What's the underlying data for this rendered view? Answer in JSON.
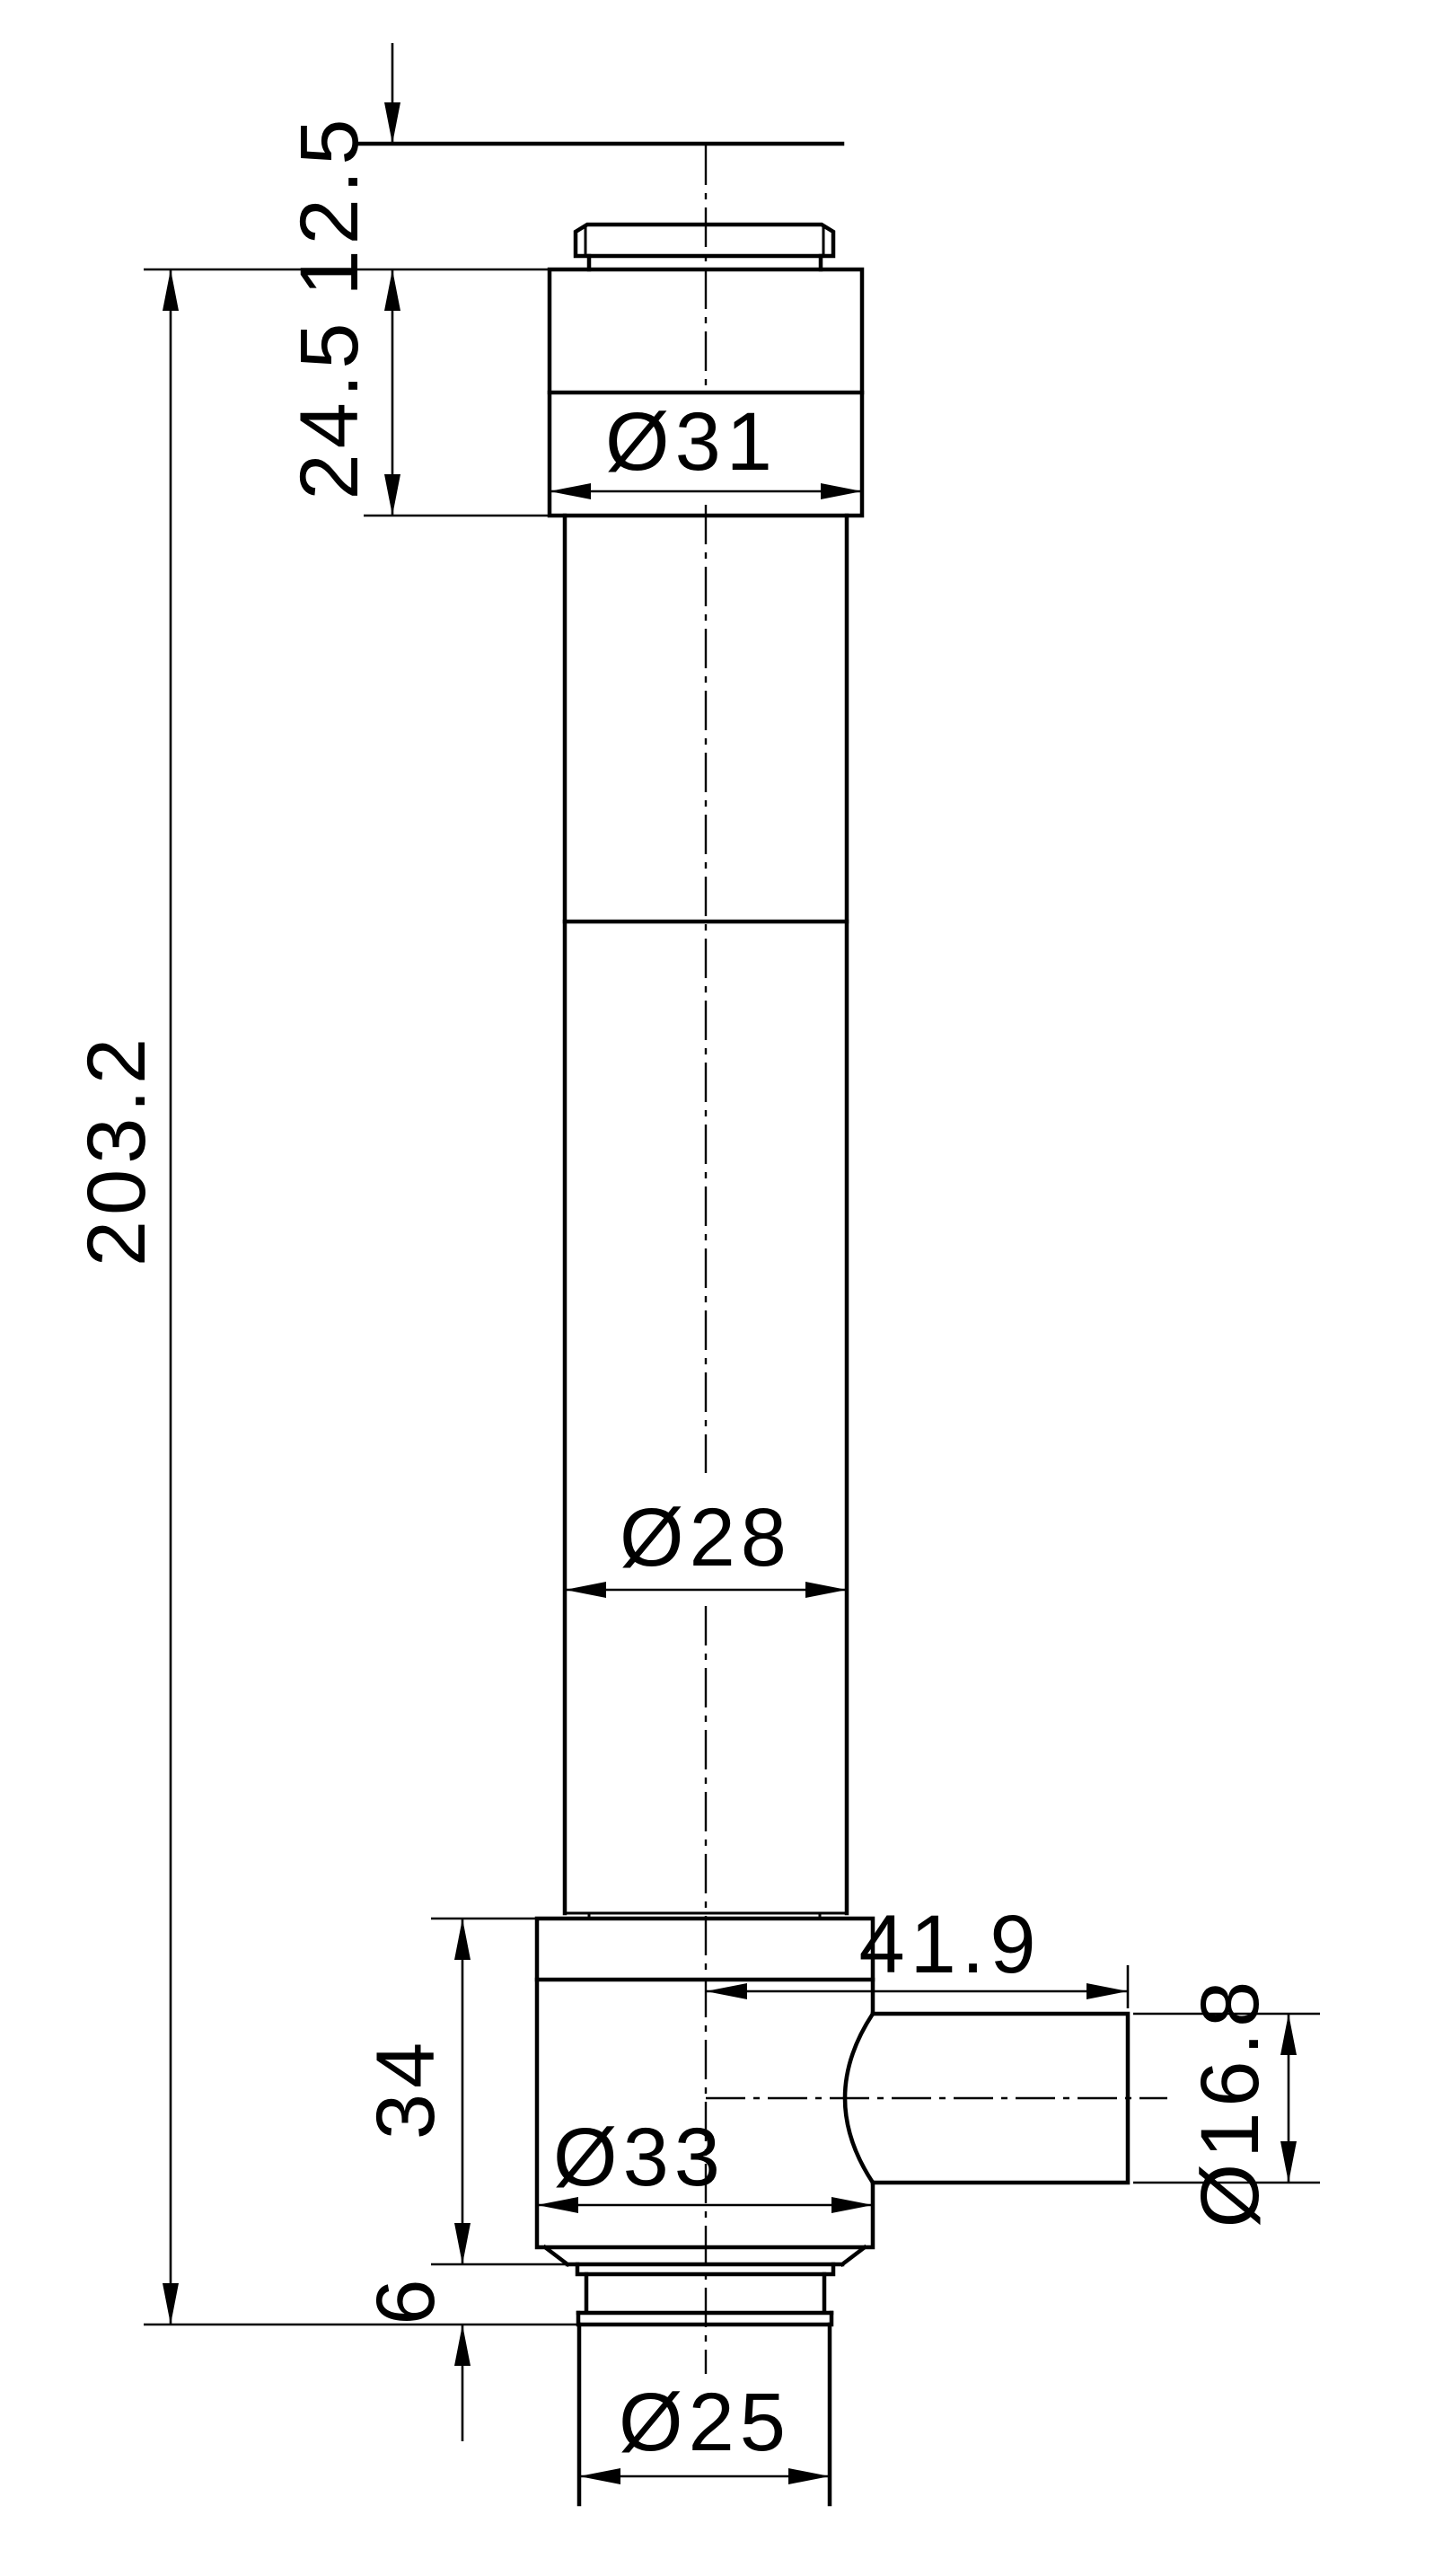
{
  "colors": {
    "background": "#ffffff",
    "line": "#000000"
  },
  "drawing": {
    "labels": {
      "top_offset": "12.5",
      "upper_block_height": "24.5",
      "upper_block_diameter": "Ø31",
      "overall_length": "203.2",
      "tube_diameter": "Ø28",
      "port_length": "41.9",
      "lower_block_height": "34",
      "lower_block_diameter": "Ø33",
      "port_diameter": "Ø16.8",
      "flange_height": "6",
      "bottom_tube_diameter": "Ø25"
    }
  }
}
